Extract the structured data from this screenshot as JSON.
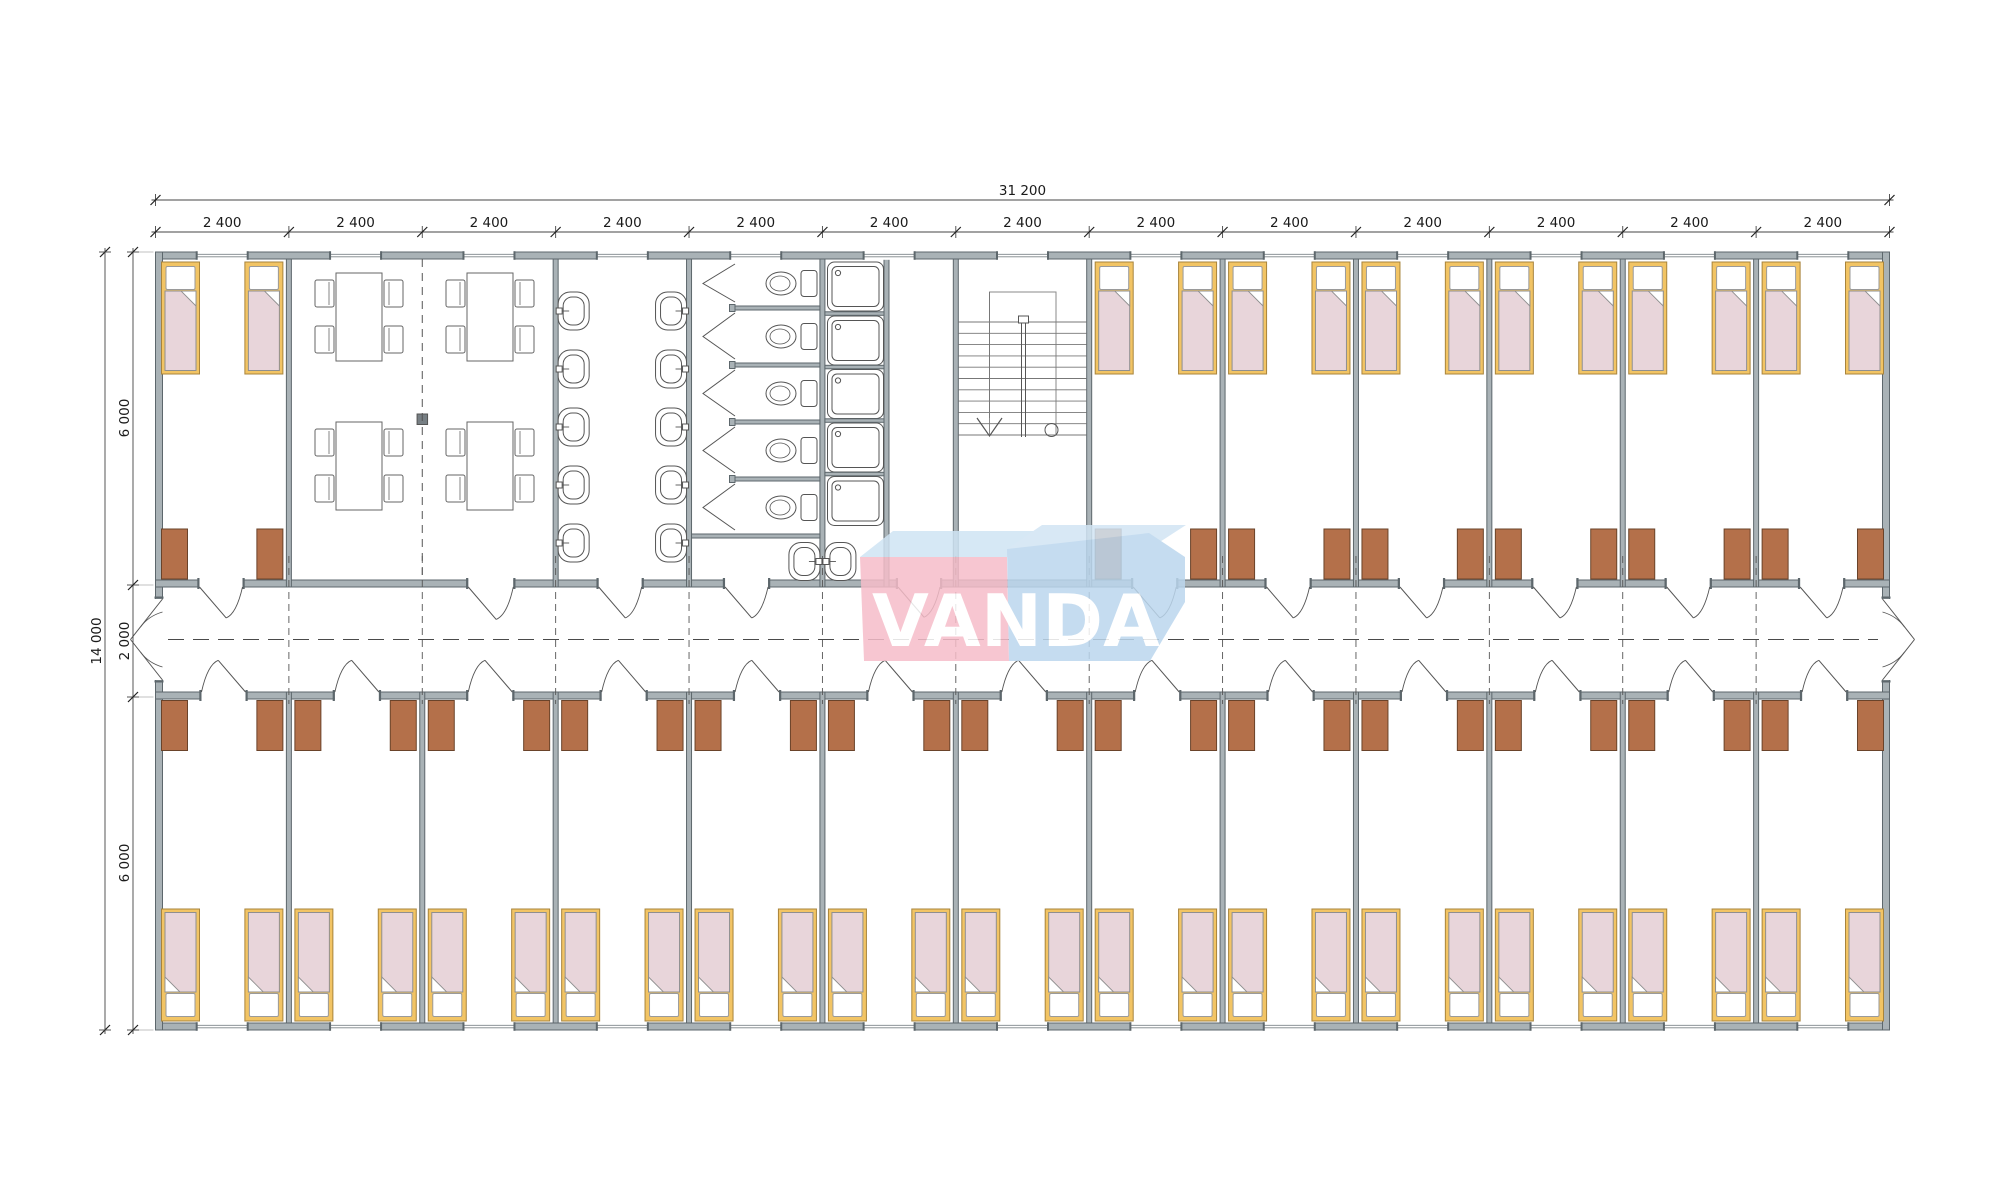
{
  "dimensions": {
    "top_total": "31 200",
    "top_segments": [
      "2 400",
      "2 400",
      "2 400",
      "2 400",
      "2 400",
      "2 400",
      "2 400",
      "2 400",
      "2 400",
      "2 400",
      "2 400",
      "2 400",
      "2 400"
    ],
    "left_total": "14 000",
    "left_segments": [
      "6 000",
      "2 000",
      "6 000"
    ]
  },
  "logo": {
    "text": "VANDA",
    "pink": "#f6bdc9",
    "blue": "#bcd7ee",
    "blue_light_left": "#cfe4f4",
    "blue_light_right": "#d2e5f4"
  },
  "colors": {
    "wall_fill": "#a9b2b6",
    "wall_stroke": "#5d676c",
    "wardrobe_fill": "#b4704a",
    "wardrobe_stroke": "#6a432a",
    "bed_frame_fill": "#f2c464",
    "bed_frame_stroke": "#a8843c",
    "blanket_fill": "#e8d5da",
    "blanket_stroke": "#8f8f8f",
    "pillow_fill": "#ffffff",
    "fixture_stroke": "#555555",
    "dash_stroke": "#4a4a4a",
    "dim_stroke": "#444444",
    "column_fill": "#777f84"
  },
  "plan": {
    "modules": 13,
    "upper_rooms": [
      {
        "type": "bedroom",
        "module": 0,
        "span": 1,
        "beds": 2,
        "wardrobes": 2
      },
      {
        "type": "dining",
        "module": 1,
        "span": 2,
        "tables": 4,
        "chairs_per_table": 4
      },
      {
        "type": "washroom",
        "module": 3,
        "span": 1,
        "basins": 10
      },
      {
        "type": "toilets",
        "module": 4,
        "span": 1,
        "stalls": 5,
        "toilets": 5
      },
      {
        "type": "showers",
        "module": 5,
        "span": 1,
        "trays": 5,
        "extra_basins": 2
      },
      {
        "type": "stairwell",
        "module": 6,
        "span": 1,
        "treads": 11
      },
      {
        "type": "bedroom",
        "module": 7,
        "span": 1,
        "beds": 2,
        "wardrobes": 2
      },
      {
        "type": "bedroom",
        "module": 8,
        "span": 1,
        "beds": 2,
        "wardrobes": 2
      },
      {
        "type": "bedroom",
        "module": 9,
        "span": 1,
        "beds": 2,
        "wardrobes": 2
      },
      {
        "type": "bedroom",
        "module": 10,
        "span": 1,
        "beds": 2,
        "wardrobes": 2
      },
      {
        "type": "bedroom",
        "module": 11,
        "span": 1,
        "beds": 2,
        "wardrobes": 2
      },
      {
        "type": "bedroom",
        "module": 12,
        "span": 1,
        "beds": 2,
        "wardrobes": 2
      }
    ],
    "lower_rooms_count": 13,
    "lower_room": {
      "type": "bedroom",
      "beds": 2,
      "wardrobes": 2
    },
    "corridor": {
      "end_doors": 2,
      "room_doors_upper": 11,
      "room_doors_lower": 13
    }
  }
}
